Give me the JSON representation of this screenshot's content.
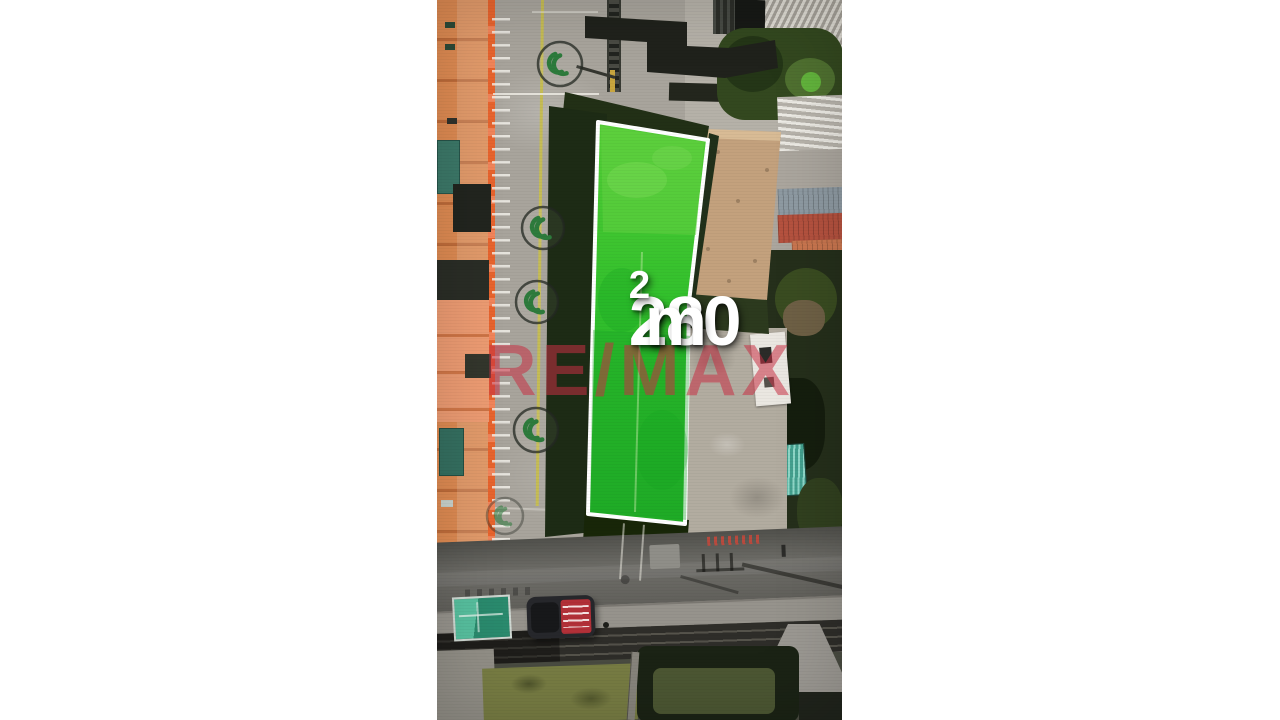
{
  "overlay": {
    "area_value": "280",
    "area_unit": "m",
    "area_superscript": "2",
    "watermark_text": "RE/MAX"
  },
  "scene": {
    "description": "Vertical aerial drone frame of a rectangular land lot highlighted in bright green with a white outline, between an orange building with a painted parking lot on the left and tin roofs, vegetation and a rubble yard on the right, a street with a parked dark pickup with red bed, a teal canopy, rails and hedges at the bottom",
    "colors": {
      "letterbox": "#ffffff",
      "lot_fill": "#31c02c",
      "lot_outline": "#ffffff",
      "label_text": "#ffffff",
      "watermark_red": "#c63044",
      "building_orange": "#dd8a52",
      "asphalt": "#63625d",
      "canopy_teal": "#3aa485",
      "car_red": "#b23038",
      "parking_logo_green": "#2d7b3c"
    }
  }
}
